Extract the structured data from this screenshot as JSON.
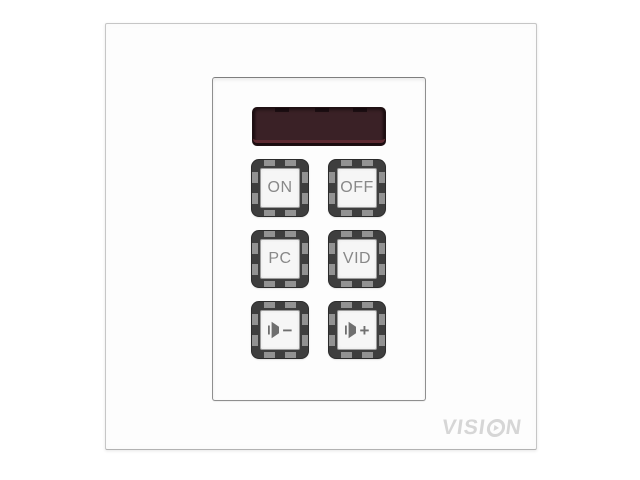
{
  "brand": "VISION",
  "logo": {
    "left": "VISI",
    "right": "N"
  },
  "led_display": {
    "text": "",
    "state": "off"
  },
  "keypad": {
    "buttons": [
      {
        "id": "on",
        "label": "ON"
      },
      {
        "id": "off",
        "label": "OFF"
      },
      {
        "id": "pc",
        "label": "PC"
      },
      {
        "id": "vid",
        "label": "VID"
      },
      {
        "id": "volume-down",
        "icon": "speaker-icon",
        "sign": "−"
      },
      {
        "id": "volume-up",
        "icon": "speaker-icon",
        "sign": "+"
      }
    ]
  },
  "colors": {
    "display_bg": "#3a2126",
    "display_rim": "#1d0e12",
    "display_strip": "#5f2b33",
    "key_frame": "#3e3e3e",
    "key_notch": "#9a9a9a",
    "keycap_bg": "#f6f6f6",
    "keycap_border": "#9c9c9c",
    "label_text": "#888888",
    "icon": "#6f6f6f",
    "logo": "#d6d6d6",
    "plate_border": "#c4c4c4",
    "panel_border": "#8f8f8f"
  }
}
